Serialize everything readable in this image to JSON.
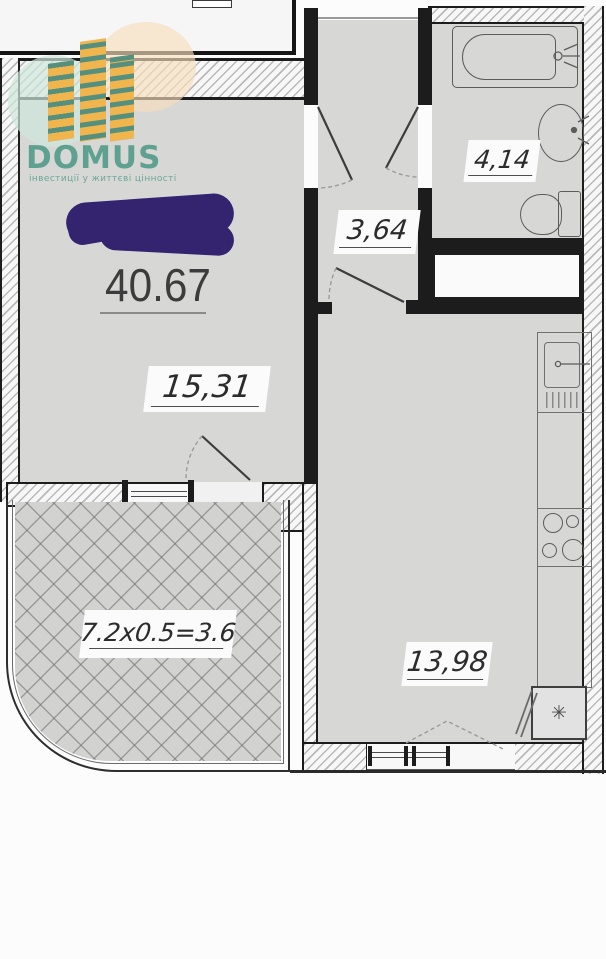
{
  "brand": {
    "name": "DOMUS",
    "tagline": "інвестиції у життєві цінності",
    "accent_teal": "#5fa190",
    "accent_yellow": "#f1b54e"
  },
  "plan": {
    "total_area": "40.67",
    "rooms": {
      "living": {
        "label": "15,31"
      },
      "hallway": {
        "label": "3,64"
      },
      "bathroom": {
        "label": "4,14"
      },
      "kitchen": {
        "label": "13,98"
      },
      "balcony": {
        "label": "7.2х0.5=3.6"
      }
    },
    "colors": {
      "room_fill": "#d7d7d6",
      "wall": "#1c1c1c",
      "redaction": "#342470"
    }
  },
  "icons": {
    "snowflake": "✳"
  }
}
